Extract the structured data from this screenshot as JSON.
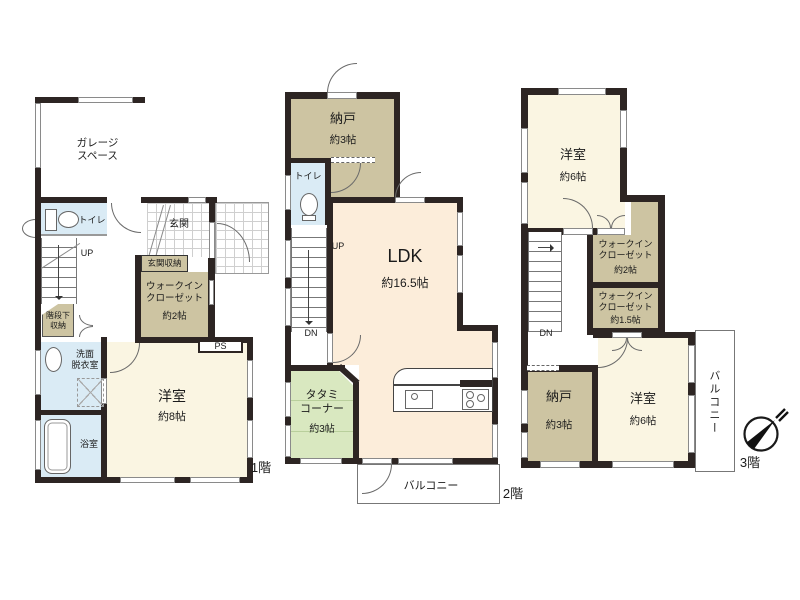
{
  "colors": {
    "wall": "#2d2523",
    "cream": "#faf5e2",
    "peach": "#fcedda",
    "tan": "#cdc4a2",
    "blue": "#daebf5",
    "green": "#d9e8c0"
  },
  "floor1": {
    "label": "1階",
    "garage": "ガレージ\nスペース",
    "toilet": "トイレ",
    "entrance": "玄関",
    "entrance_storage": "玄関収納",
    "wic": "ウォークイン\nクローゼット",
    "wic_size": "約2帖",
    "understair": "階段下\n収納",
    "up": "UP",
    "washroom": "洗面\n脱衣室",
    "bath": "浴室",
    "bedroom": "洋室",
    "bedroom_size": "約8帖",
    "ps": "PS"
  },
  "floor2": {
    "label": "2階",
    "storage": "納戸",
    "storage_size": "約3帖",
    "toilet": "トイレ",
    "up": "UP",
    "dn": "DN",
    "ldk": "LDK",
    "ldk_size": "約16.5帖",
    "tatami": "タタミ\nコーナー",
    "tatami_size": "約3帖",
    "balcony": "バルコニー"
  },
  "floor3": {
    "label": "3階",
    "bedroom_top": "洋室",
    "bedroom_top_size": "約6帖",
    "wic1": "ウォークイン\nクローゼット",
    "wic1_size": "約2帖",
    "wic2": "ウォークイン\nクローゼット",
    "wic2_size": "約1.5帖",
    "dn": "DN",
    "storage": "納戸",
    "storage_size": "約3帖",
    "bedroom_bottom": "洋室",
    "bedroom_bottom_size": "約6帖",
    "balcony": "バルコニー"
  }
}
